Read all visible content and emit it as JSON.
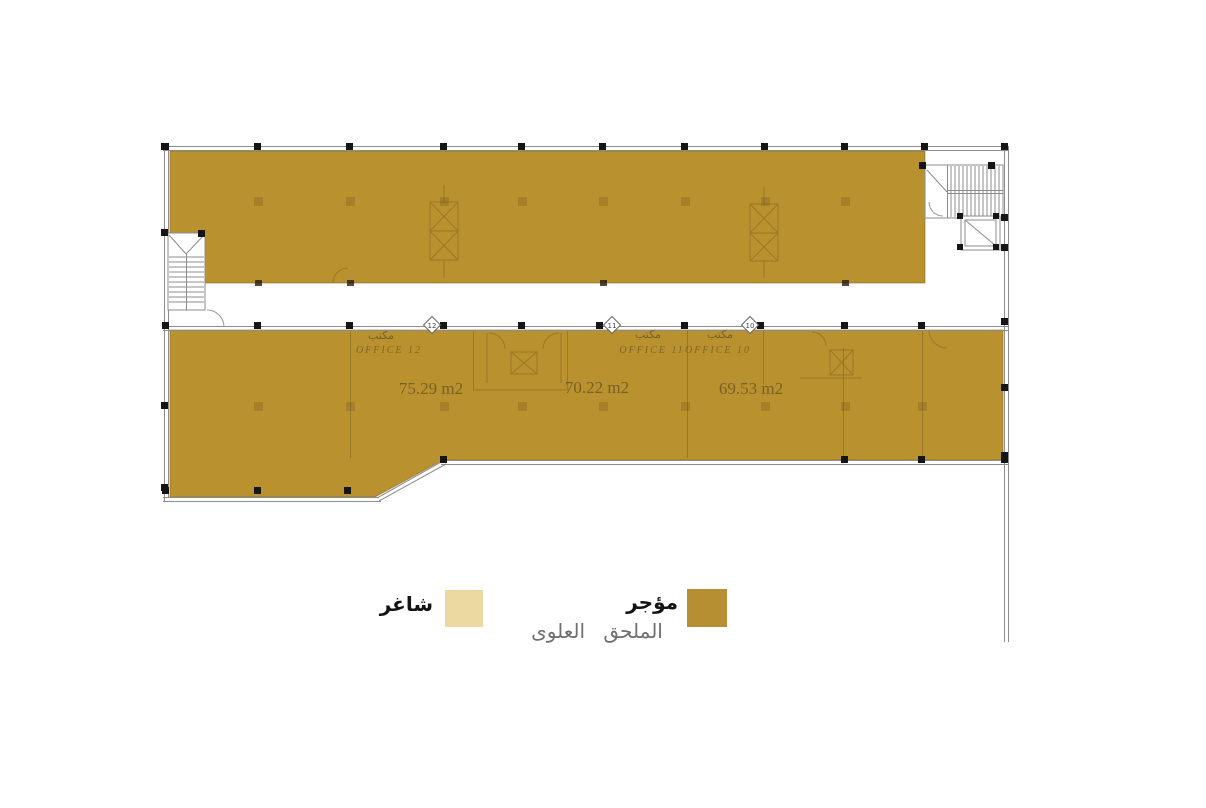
{
  "title": "الملحق العلوى",
  "legend": {
    "vacant_label": "شاغر",
    "vacant_color": "#EBD9A1",
    "rented_label": "مؤجر",
    "rented_color": "#B78F33"
  },
  "plan": {
    "fill_color": "#B9912F",
    "units": [
      {
        "tag": "12",
        "name_ar": "مكتب",
        "name_en": "OFFICE  12",
        "area": "75.29 m2"
      },
      {
        "tag": "11",
        "name_ar": "مكتب",
        "name_en": "OFFICE  11",
        "area": "70.22 m2"
      },
      {
        "tag": "10",
        "name_ar": "مكتب",
        "name_en": "OFFICE  10",
        "area": "69.53 m2"
      }
    ]
  }
}
